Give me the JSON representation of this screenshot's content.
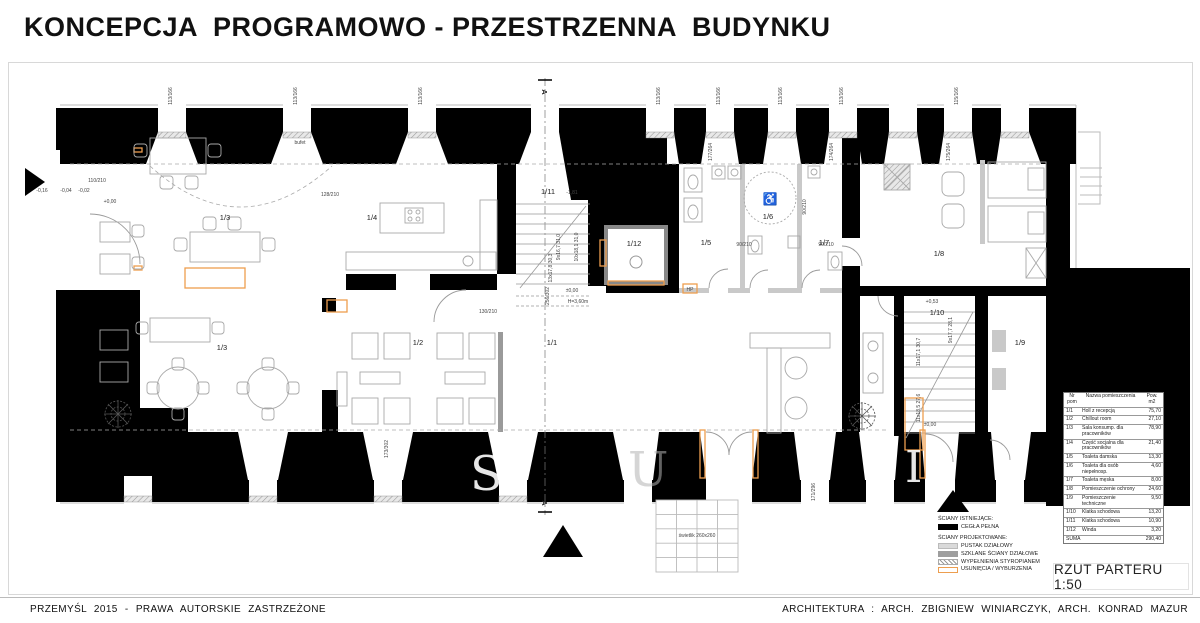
{
  "title": "KONCEPCJA  PROGRAMOWO - PRZESTRZENNA  BUDYNKU",
  "scale_label": "RZUT PARTERU 1:50",
  "footer": {
    "left": "PRZEMYŚL  2015  -  PRAWA  AUTORSKIE  ZASTRZEŻONE",
    "right": "ARCHITEKTURA : ARCH. ZBIGNIEW  WINIARCZYK,  ARCH.  KONRAD  MAZUR"
  },
  "colors": {
    "wall_existing": "#000000",
    "partition_projected": "#c9c9c9",
    "glass_wall": "#9a9a9a",
    "demolition": "#ED9E4F",
    "furniture": "#a9a9a9"
  },
  "section_markers": {
    "top": "A",
    "bottom": "A"
  },
  "watermark": {
    "s": "S",
    "u": "U",
    "i": "I"
  },
  "legend": {
    "existing_title": "ŚCIANY ISTNIEJĄCE:",
    "existing_items": [
      {
        "label": "CEGŁA PEŁNA"
      }
    ],
    "projected_title": "ŚCIANY PROJEKTOWANE:",
    "projected_items": [
      {
        "label": "PUSTAK DZIAŁOWY"
      },
      {
        "label": "SZKLANE ŚCIANY DZIAŁOWE"
      },
      {
        "label": "WYPEŁNIENIA STYROPIANEM"
      },
      {
        "label": "USUNIĘCIA / WYBURZENIA"
      }
    ]
  },
  "room_table": {
    "headers": {
      "nr": "Nr pom",
      "name": "Nazwa pomieszczenia",
      "area": "Pow. m2"
    },
    "rows": [
      {
        "nr": "1/1",
        "name": "Holl z recepcją",
        "area": "75,70"
      },
      {
        "nr": "1/2",
        "name": "Chillout room",
        "area": "27,10"
      },
      {
        "nr": "1/3",
        "name": "Sala konsump. dla pracowników",
        "area": "78,90"
      },
      {
        "nr": "1/4",
        "name": "Część socjalna dla pracowników",
        "area": "21,40"
      },
      {
        "nr": "1/5",
        "name": "Toaleta damska",
        "area": "13,30"
      },
      {
        "nr": "1/6",
        "name": "Toaleta dla osób niepełnosp.",
        "area": "4,60"
      },
      {
        "nr": "1/7",
        "name": "Toaleta męska",
        "area": "8,00"
      },
      {
        "nr": "1/8",
        "name": "Pomieszczenie ochrony",
        "area": "24,60"
      },
      {
        "nr": "1/9",
        "name": "Pomieszczenie techniczne",
        "area": "9,50"
      },
      {
        "nr": "1/10",
        "name": "Klatka schodowa",
        "area": "13,20"
      },
      {
        "nr": "1/11",
        "name": "Klatka schodowa",
        "area": "10,90"
      },
      {
        "nr": "1/12",
        "name": "Winda",
        "area": "3,20"
      }
    ],
    "total": {
      "label": "SUMA",
      "area": "290,40"
    }
  },
  "rooms": [
    {
      "label": "1/3"
    },
    {
      "label": "1/3"
    },
    {
      "label": "1/4"
    },
    {
      "label": "1/11"
    },
    {
      "label": "1/12"
    },
    {
      "label": "1/5"
    },
    {
      "label": "1/6"
    },
    {
      "label": "1/7"
    },
    {
      "label": "1/8"
    },
    {
      "label": "1/2"
    },
    {
      "label": "1/1"
    },
    {
      "label": "1/10"
    },
    {
      "label": "1/9"
    }
  ],
  "dims": [
    {
      "t": "113/166"
    },
    {
      "t": "113/166"
    },
    {
      "t": "113/166"
    },
    {
      "t": "113/166"
    },
    {
      "t": "113/166"
    },
    {
      "t": "113/166"
    },
    {
      "t": "113/166"
    },
    {
      "t": "115/166"
    },
    {
      "t": "177/264"
    },
    {
      "t": "174/264"
    },
    {
      "t": "175/264"
    },
    {
      "t": "110/210"
    },
    {
      "t": "-0,16"
    },
    {
      "t": "-0,04"
    },
    {
      "t": "-0,02"
    },
    {
      "t": "+0,00"
    },
    {
      "t": "128/210"
    },
    {
      "t": "bufet"
    },
    {
      "t": "-1,81"
    },
    {
      "t": "90/210"
    },
    {
      "t": "90/210"
    },
    {
      "t": "90/210"
    },
    {
      "t": "130/210"
    },
    {
      "t": "256/302"
    },
    {
      "t": "±0,00"
    },
    {
      "t": "H=3,60m"
    },
    {
      "t": "+0,53"
    },
    {
      "t": "±0,00"
    },
    {
      "t": "9x16,7 31,0"
    },
    {
      "t": "10x18,1 31,0"
    },
    {
      "t": "13x17,8 30,3"
    },
    {
      "t": "11x17,1 30,7"
    },
    {
      "t": "11x18,5 27,6"
    },
    {
      "t": "9x17,7 28,1"
    },
    {
      "t": "173/302"
    },
    {
      "t": "171/296"
    },
    {
      "t": "świetlik 260x260"
    },
    {
      "t": "HP"
    }
  ]
}
